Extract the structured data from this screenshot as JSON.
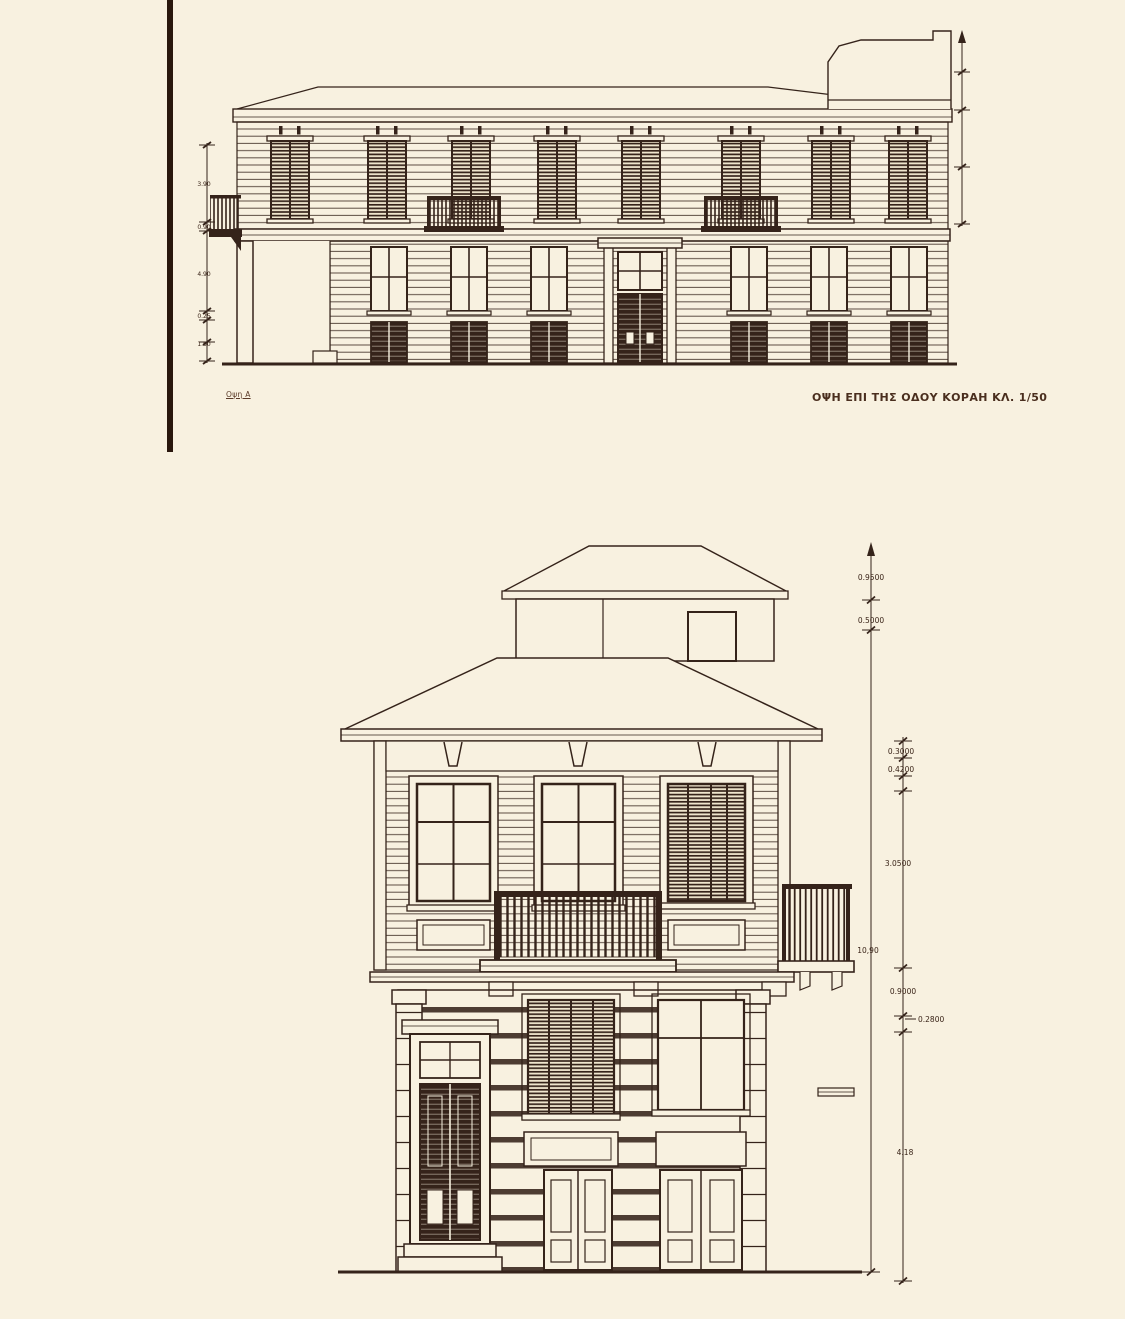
{
  "colors": {
    "background": "#f8f1e0",
    "ink": "#35231a"
  },
  "top_drawing": {
    "name_label": "Οψη Α",
    "title": "ΟΨΗ ΕΠΙ ΤΗΣ ΟΔΟΥ ΚΟΡΑΗ ΚΛ. 1/50",
    "left_dims": [
      "3.90",
      "0.90",
      "4.90",
      "0.25",
      "1.50"
    ]
  },
  "bottom_drawing": {
    "dims": {
      "top1": "0.9500",
      "top2": "0.5000",
      "roof1": "0.3000",
      "roof2": "0.4200",
      "storey": "3.0500",
      "total": "10,90",
      "band": "0.9000",
      "plinth": "0.2800",
      "ground": "4.18"
    }
  }
}
